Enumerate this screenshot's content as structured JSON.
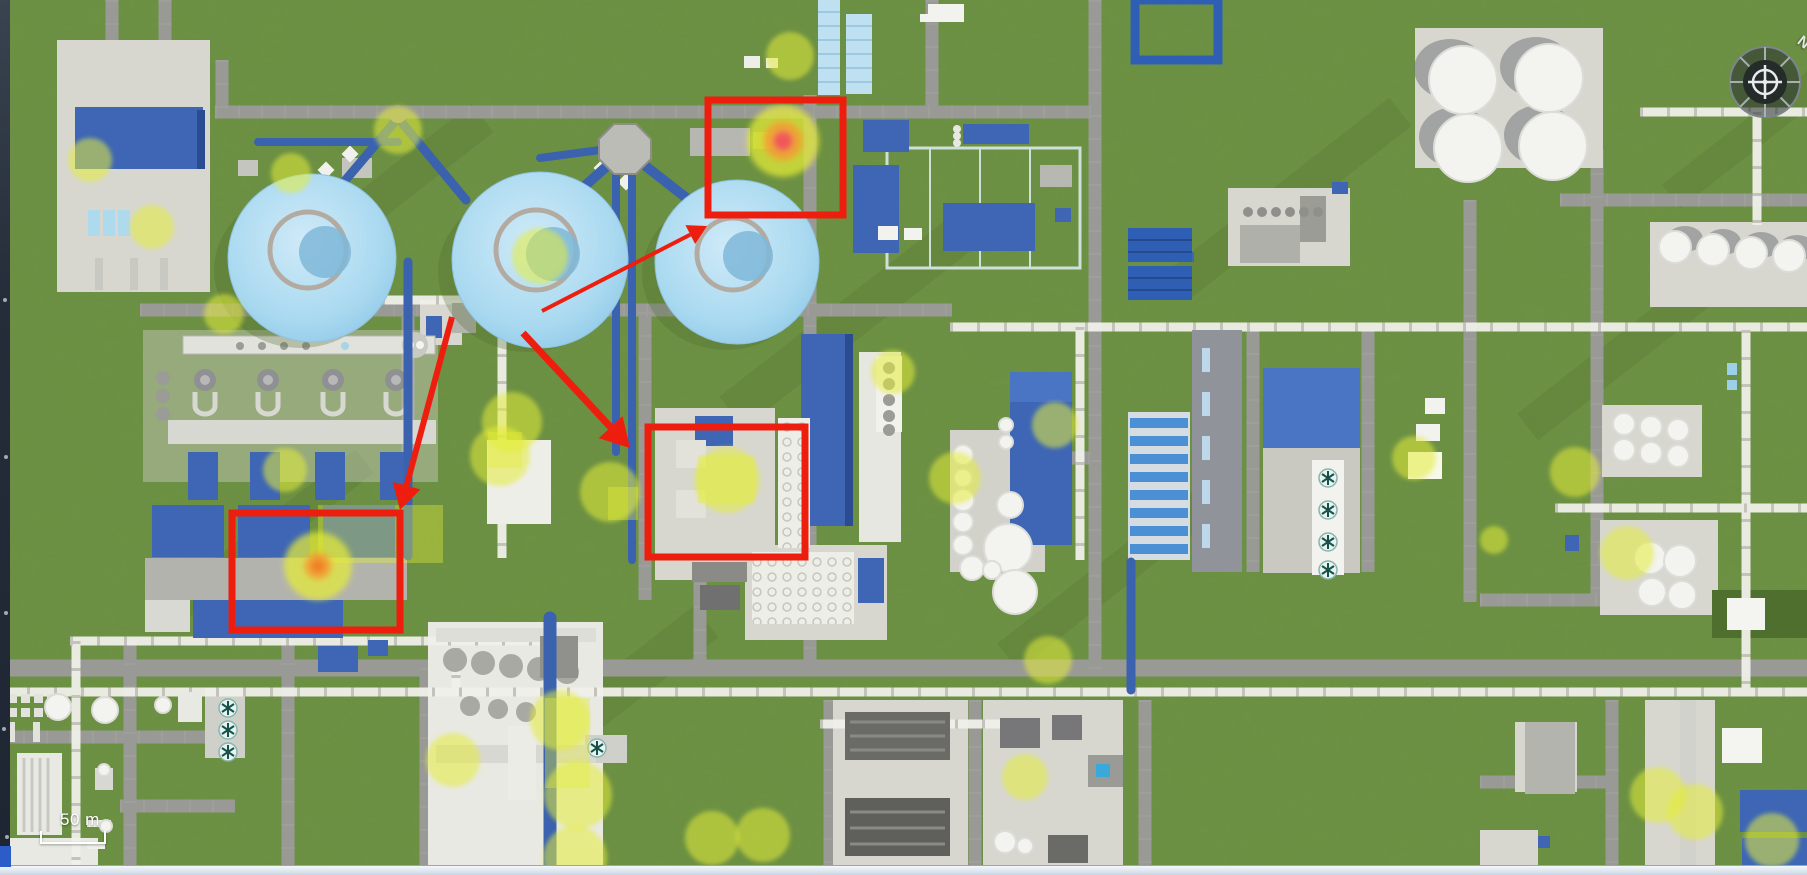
{
  "view": {
    "width": 1807,
    "height": 875
  },
  "colors": {
    "annotation_red": "#ee1e0f",
    "marker_yellow": "#e4ec38",
    "heat_orange": "#f59a31",
    "grass": "#6c9142",
    "road": "#999a96",
    "dome_blue": "#a9d9f0",
    "roof_blue": "#3e66b5",
    "rack_white": "#f0f0ea"
  },
  "hud": {
    "scale_label": "50 m",
    "compass_label": "N"
  },
  "annotations": {
    "rectangles": [
      {
        "x": 708,
        "y": 100,
        "w": 135,
        "h": 115
      },
      {
        "x": 232,
        "y": 513,
        "w": 168,
        "h": 117
      },
      {
        "x": 648,
        "y": 427,
        "w": 157,
        "h": 130
      }
    ],
    "arrows": [
      {
        "x1": 542,
        "y1": 311,
        "x2": 707,
        "y2": 226,
        "width": 4
      },
      {
        "x1": 523,
        "y1": 333,
        "x2": 630,
        "y2": 448,
        "width": 7
      },
      {
        "x1": 452,
        "y1": 317,
        "x2": 400,
        "y2": 510,
        "width": 6
      }
    ]
  },
  "hotspots": [
    {
      "x": 783,
      "y": 141,
      "yellow_r": 36,
      "mid_r": 20,
      "core_r": 10,
      "core_color": "#f2545c"
    },
    {
      "x": 318,
      "y": 566,
      "yellow_r": 34,
      "mid_r": 14,
      "core_r": 7,
      "core_color": "#ef8025"
    }
  ],
  "markers": [
    {
      "x": 90,
      "y": 160,
      "r": 22
    },
    {
      "x": 152,
      "y": 227,
      "r": 22
    },
    {
      "x": 291,
      "y": 173,
      "r": 20
    },
    {
      "x": 398,
      "y": 130,
      "r": 24
    },
    {
      "x": 540,
      "y": 256,
      "r": 28
    },
    {
      "x": 790,
      "y": 56,
      "r": 24
    },
    {
      "x": 224,
      "y": 314,
      "r": 20
    },
    {
      "x": 285,
      "y": 470,
      "r": 22
    },
    {
      "x": 512,
      "y": 422,
      "r": 30
    },
    {
      "x": 500,
      "y": 456,
      "r": 30
    },
    {
      "x": 610,
      "y": 492,
      "r": 30
    },
    {
      "x": 727,
      "y": 480,
      "r": 33
    },
    {
      "x": 893,
      "y": 372,
      "r": 22
    },
    {
      "x": 955,
      "y": 478,
      "r": 26
    },
    {
      "x": 1055,
      "y": 425,
      "r": 23
    },
    {
      "x": 1048,
      "y": 660,
      "r": 24
    },
    {
      "x": 1025,
      "y": 777,
      "r": 23
    },
    {
      "x": 453,
      "y": 760,
      "r": 27
    },
    {
      "x": 560,
      "y": 720,
      "r": 30
    },
    {
      "x": 578,
      "y": 795,
      "r": 34
    },
    {
      "x": 575,
      "y": 858,
      "r": 32
    },
    {
      "x": 712,
      "y": 838,
      "r": 27
    },
    {
      "x": 763,
      "y": 835,
      "r": 27
    },
    {
      "x": 1414,
      "y": 458,
      "r": 22
    },
    {
      "x": 1575,
      "y": 472,
      "r": 25
    },
    {
      "x": 1627,
      "y": 553,
      "r": 27
    },
    {
      "x": 1494,
      "y": 540,
      "r": 14
    },
    {
      "x": 1658,
      "y": 795,
      "r": 28
    },
    {
      "x": 1695,
      "y": 812,
      "r": 28
    },
    {
      "x": 1772,
      "y": 840,
      "r": 27
    }
  ],
  "zones": [
    {
      "x": 318,
      "y": 505,
      "w": 125,
      "h": 58
    },
    {
      "x": 488,
      "y": 432,
      "w": 34,
      "h": 36
    },
    {
      "x": 608,
      "y": 487,
      "w": 30,
      "h": 33
    },
    {
      "x": 698,
      "y": 455,
      "w": 58,
      "h": 48
    },
    {
      "x": 753,
      "y": 132,
      "w": 28,
      "h": 17
    },
    {
      "x": 545,
      "y": 698,
      "w": 45,
      "h": 90
    }
  ]
}
